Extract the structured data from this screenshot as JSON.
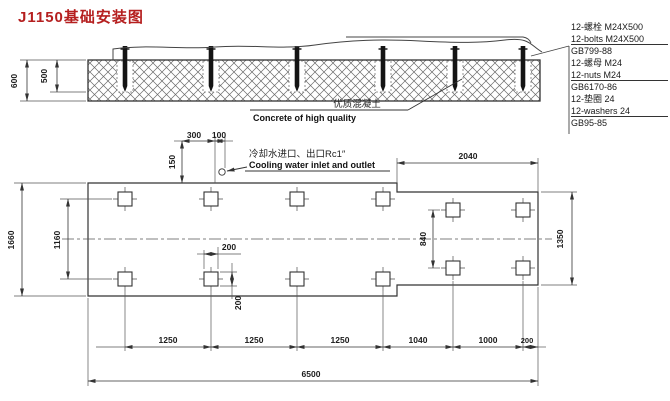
{
  "title": "J1150基础安装图",
  "colors": {
    "title_red": "#b51f1f",
    "line": "#3b3b3b",
    "background": "#ffffff"
  },
  "notes": {
    "concrete_cn": "优质混凝土",
    "concrete_en": "Concrete of high quality",
    "cooling_cn": "冷却水进口、出口Rc1″",
    "cooling_en": "Cooling water inlet and outlet"
  },
  "parts": {
    "lines": [
      {
        "text": "12-螺栓 M24X500"
      },
      {
        "text": "12-bolts M24X500"
      },
      {
        "text": "GB799-88"
      },
      {
        "text": "12-螺母 M24"
      },
      {
        "text": "12-nuts M24"
      },
      {
        "text": "GB6170-86"
      },
      {
        "text": "12-垫圈 24"
      },
      {
        "text": "12-washers 24"
      },
      {
        "text": "GB95-85"
      }
    ]
  },
  "dims": {
    "section_total_depth": "600",
    "section_bolt_depth": "500",
    "plan_height": "1660",
    "plan_row_spacing": "1160",
    "offset_300": "300",
    "offset_100": "100",
    "offset_150": "150",
    "pocket_width": "200",
    "pocket_height": "200",
    "bottom": [
      "1250",
      "1250",
      "1250",
      "1040",
      "1000",
      "200"
    ],
    "total_length": "6500",
    "right_width": "2040",
    "right_height": "1350",
    "right_row_spacing": "840"
  }
}
